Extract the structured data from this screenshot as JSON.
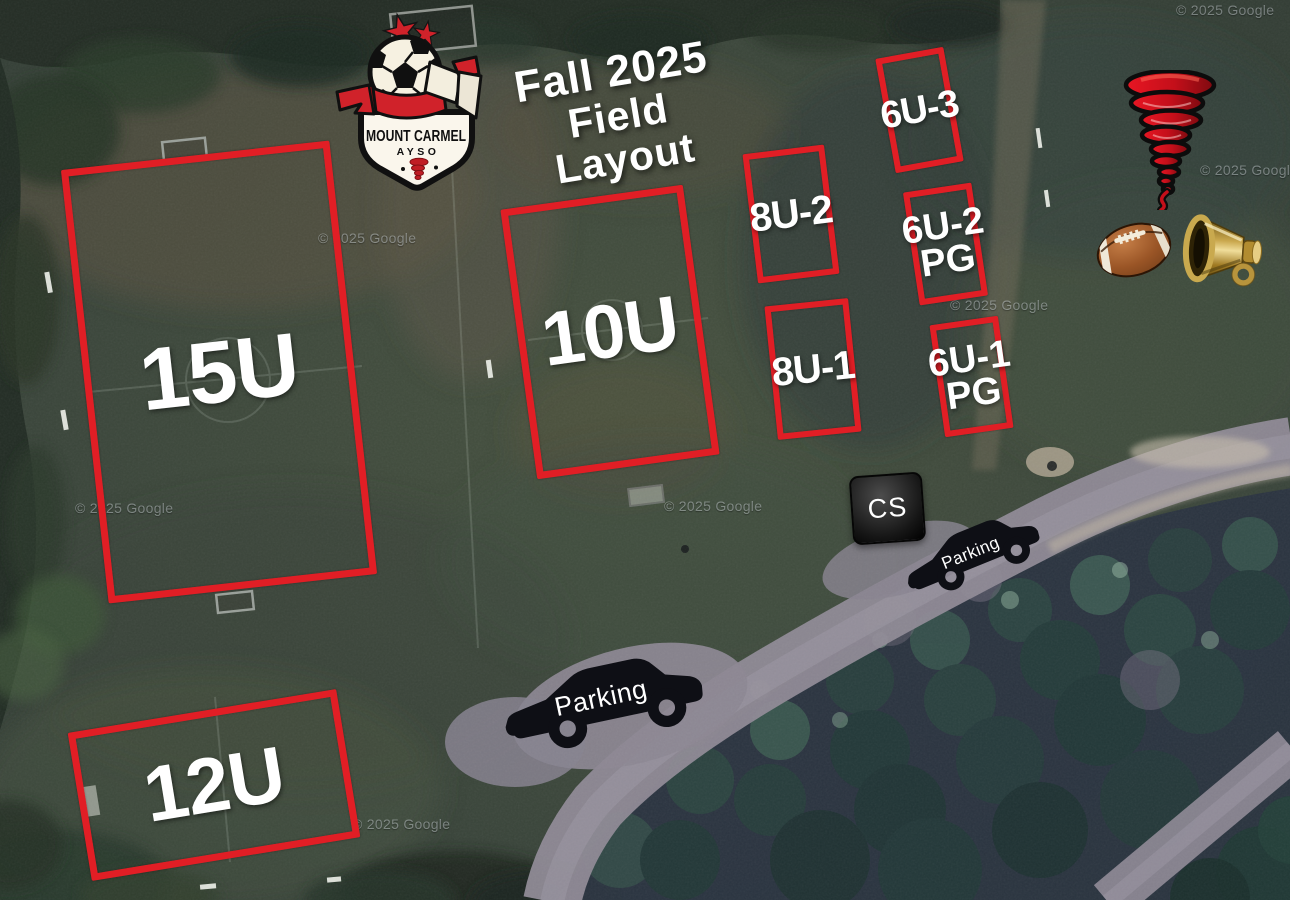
{
  "event_title": {
    "line1": "Fall 2025",
    "line2": "Field Layout"
  },
  "logo": {
    "club_name": "MOUNT CARMEL",
    "organization": "AYSO"
  },
  "fields": [
    {
      "label": "15U"
    },
    {
      "label": "10U"
    },
    {
      "label": "12U"
    },
    {
      "label": "8U-2"
    },
    {
      "label": "8U-1"
    },
    {
      "label": "6U-3"
    },
    {
      "label": "6U-2",
      "sublabel": "PG"
    },
    {
      "label": "6U-1",
      "sublabel": "PG"
    }
  ],
  "markers": {
    "concession": "CS",
    "parking": "Parking"
  },
  "map_attribution": "© 2025 Google",
  "icons": {
    "star": "★",
    "club_badge": "soccer-ball-icon",
    "mascot": "tornado-icon",
    "football": "football-icon",
    "cheer": "megaphone-icon",
    "parking_vehicle": "car-icon"
  },
  "colors": {
    "field_outline": "#e11e25",
    "label_text": "#ffffff",
    "logo_red": "#d0222a",
    "marker_fill": "#111118"
  }
}
